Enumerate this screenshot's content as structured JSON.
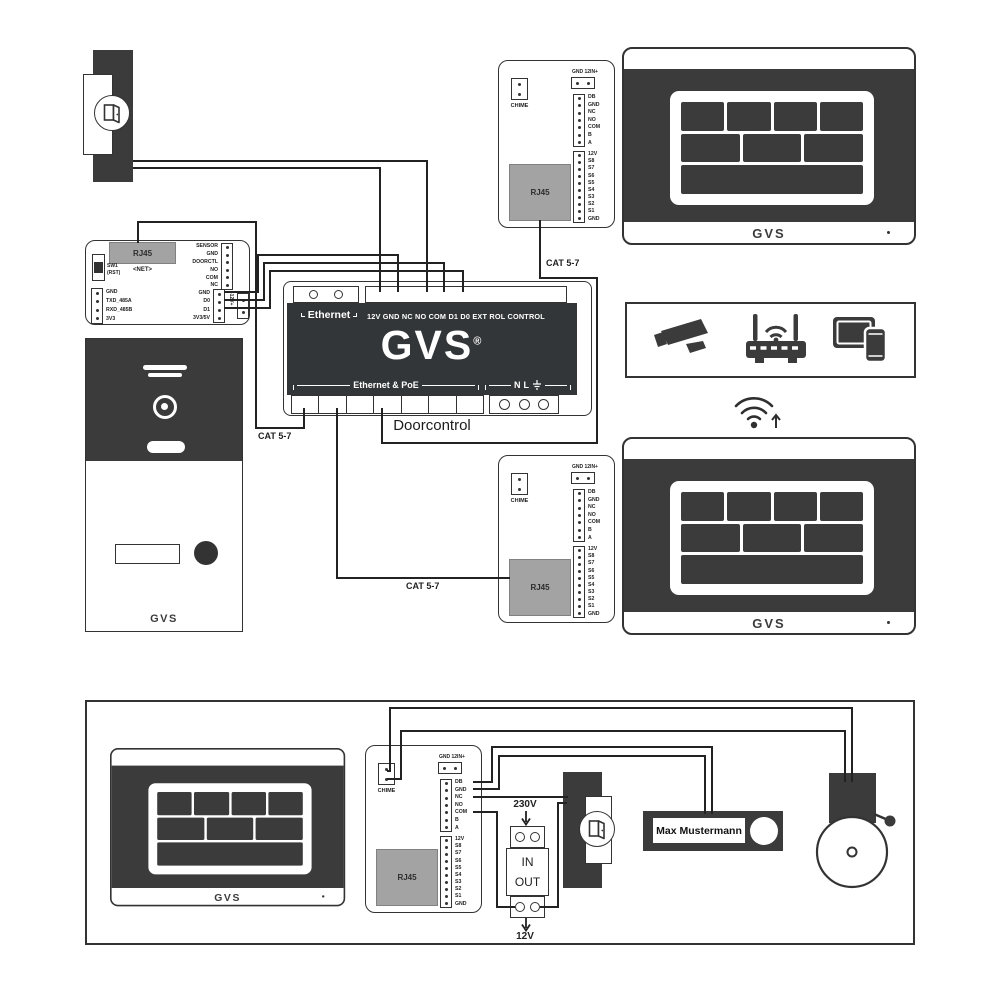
{
  "net_module": {
    "rj45_label": "RJ45",
    "net_label": "<NET>",
    "sw_label": "SW1",
    "sw_sub": "(RST)",
    "uart_terminals": [
      "GND",
      "TXD_485A",
      "RXD_485B",
      "3V3"
    ],
    "io_terminals": [
      "SENSOR",
      "GND",
      "DOORCTL",
      "NO",
      "COM",
      "NC"
    ],
    "wiegand_terminals": [
      "GND",
      "D0",
      "D1",
      "3V3/5V"
    ],
    "power_label": "-12V+"
  },
  "doorcontrol": {
    "ethernet_label": "Ethernet",
    "terminal_labels": "12V GND NC NO COM D1 D0 EXT ROL CONTROL",
    "logo": "GVS",
    "reg_mark": "®",
    "poe_label": "Ethernet & PoE",
    "mains_n": "N",
    "mains_l": "L",
    "caption": "Doorcontrol"
  },
  "cat_label": "CAT 5-7",
  "chime_module": {
    "chime_label": "CHIME",
    "power_label": "GND 12IN+",
    "relay_terminals": [
      "DB",
      "GND",
      "NC",
      "NO",
      "COM",
      "B",
      "A"
    ],
    "signal_terminals": [
      "12V",
      "S8",
      "S7",
      "S6",
      "S5",
      "S4",
      "S3",
      "S2",
      "S1",
      "GND"
    ],
    "rj45_label": "RJ45"
  },
  "monitor": {
    "logo": "GVS"
  },
  "door_station": {
    "logo": "GVS"
  },
  "psu": {
    "input_label": "230V",
    "in_label": "IN",
    "out_label": "OUT",
    "output_label": "12V"
  },
  "doorbell": {
    "name_tag": "Max Mustermann"
  },
  "colors": {
    "dark": "#3b3b3b",
    "line": "#222222",
    "rj45_gray": "#a3a3a3"
  }
}
